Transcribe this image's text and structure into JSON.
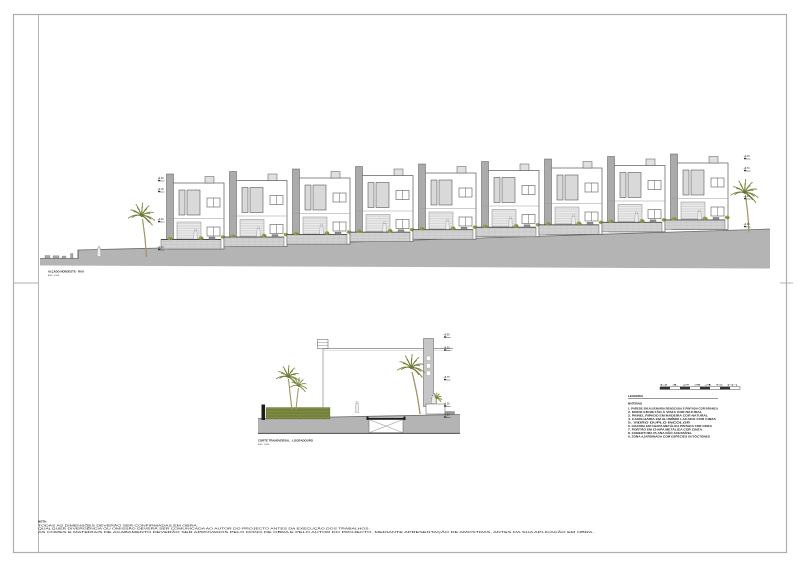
{
  "elevation": {
    "caption": "ALÇADO NORDESTE - RUA",
    "caption_scale": "ESC. 1:200",
    "house_count": 9,
    "level_markers_left": [
      "+6.60",
      "+6.15",
      "+3.40",
      "+0.70"
    ],
    "level_markers_right": [
      "+9.15",
      "+8.70",
      "+5.95",
      "+3.25"
    ]
  },
  "section": {
    "caption": "CORTE TRANSVERSAL - LOGRADOURO",
    "caption_scale": "ESC. 1:200",
    "level_markers": [
      "+8.95",
      "+8.50",
      "+5.75",
      "+3.05",
      "+2.60"
    ]
  },
  "legend": {
    "title": "LEGENDA",
    "subtitle": "MATERIAIS",
    "scale_labels": "0  1  2  3  4  5 m",
    "items": [
      "1. PAREDE EM ALVENARIA REBOCADA E PINTADA COR BRANCA",
      "2. MURO EM BETÃO À VISTA COR NATURAL",
      "3. PAINEL RIPADO EM MADEIRA COR NATURAL",
      "4. CAIXILHARIA EM ALUMÍNIO LACADO COR CINZA",
      "5. VIDRO DUPLO INCOLOR",
      "6. GUARDA EM CHAPA METÁLICA PINTADA COR CINZA",
      "7. PORTÃO EM CHAPA METÁLICA COR CINZA",
      "8. COBERTURA PLANA NÃO ACESSÍVEL",
      "9. ZONA AJARDINADA COM ESPÉCIES AUTÓCTONES"
    ]
  },
  "notes": {
    "title": "NOTA:",
    "lines": [
      "TODAS AS DIMENSÕES DEVERÃO SER CONFIRMADAS EM OBRA.",
      "QUALQUER DIVERGÊNCIA OU OMISSÃO DEVERÁ SER COMUNICADA AO AUTOR DO PROJECTO ANTES DA EXECUÇÃO DOS TRABALHOS.",
      "AS CORES E MATERIAIS DE ACABAMENTO DEVERÃO SER APROVADOS PELO DONO DE OBRA E PELO AUTOR DO PROJECTO, MEDIANTE APRESENTAÇÃO DE AMOSTRAS, ANTES DA SUA APLICAÇÃO EM OBRA."
    ]
  },
  "colors": {
    "ground": "#b4b4b4",
    "line": "#5a5a5a",
    "vegetation": "#7f8b40",
    "hedge": "#7d8c42",
    "glazing": "#d9d9d9"
  }
}
